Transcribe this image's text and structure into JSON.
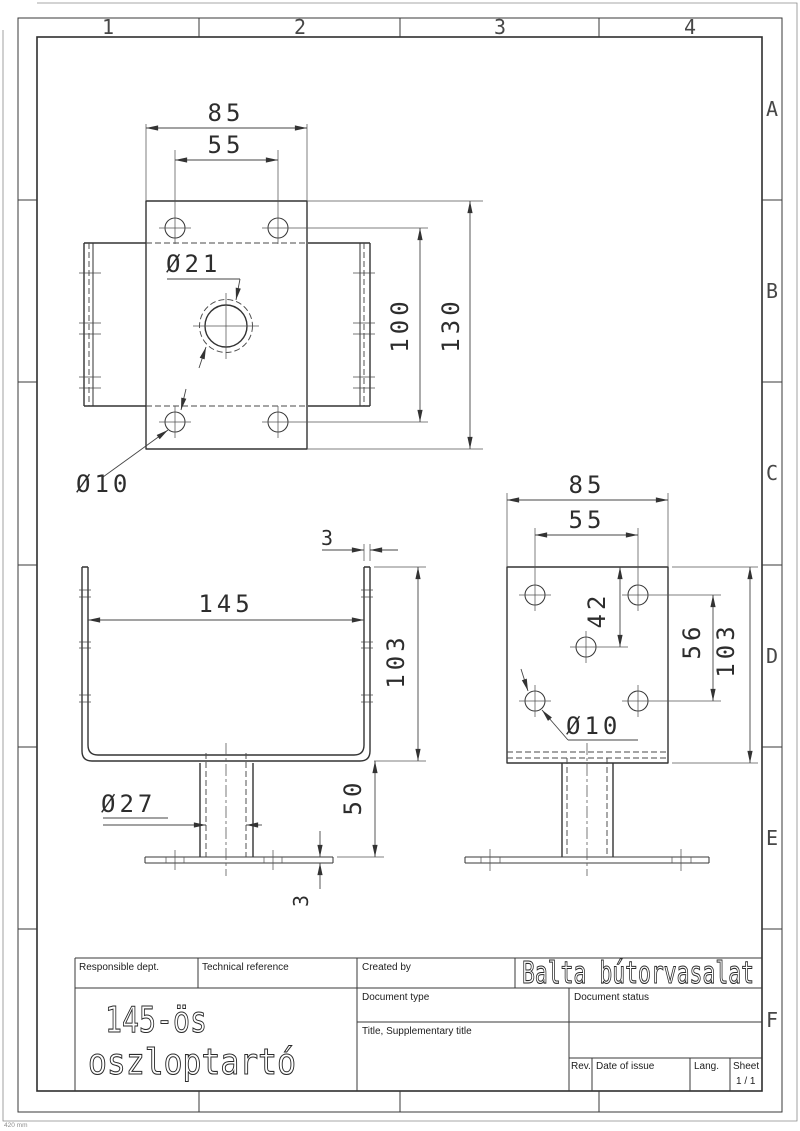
{
  "sheet": {
    "columns": [
      "1",
      "2",
      "3",
      "4"
    ],
    "rows": [
      "A",
      "B",
      "C",
      "D",
      "E",
      "F"
    ],
    "corner_note": "420 mm"
  },
  "title_block": {
    "responsible_dept_label": "Responsible dept.",
    "technical_reference_label": "Technical reference",
    "created_by_label": "Created by",
    "company": "Balta bútorvasalat",
    "document_type_label": "Document type",
    "document_status_label": "Document status",
    "title_label": "Title, Supplementary title",
    "rev_label": "Rev.",
    "date_of_issue_label": "Date of issue",
    "lang_label": "Lang.",
    "sheet_label": "Sheet",
    "sheet_number": "1 / 1",
    "drawing_title_line1": "145-ös",
    "drawing_title_line2": "oszloptartó"
  },
  "views": {
    "top": {
      "width": "85",
      "bolt_spacing": "55",
      "center_hole": "Ø21",
      "bolt_row_spacing": "100",
      "length": "130",
      "bolt_hole": "Ø10"
    },
    "front": {
      "wall_thickness": "3",
      "inner_width": "145",
      "height": "103",
      "post_diameter": "Ø27",
      "post_height": "50",
      "base_thickness": "3"
    },
    "side": {
      "width": "85",
      "bolt_spacing": "55",
      "mid_hole_offset": "42",
      "bolt_row_spacing": "56",
      "height": "103",
      "bolt_hole": "Ø10"
    }
  }
}
